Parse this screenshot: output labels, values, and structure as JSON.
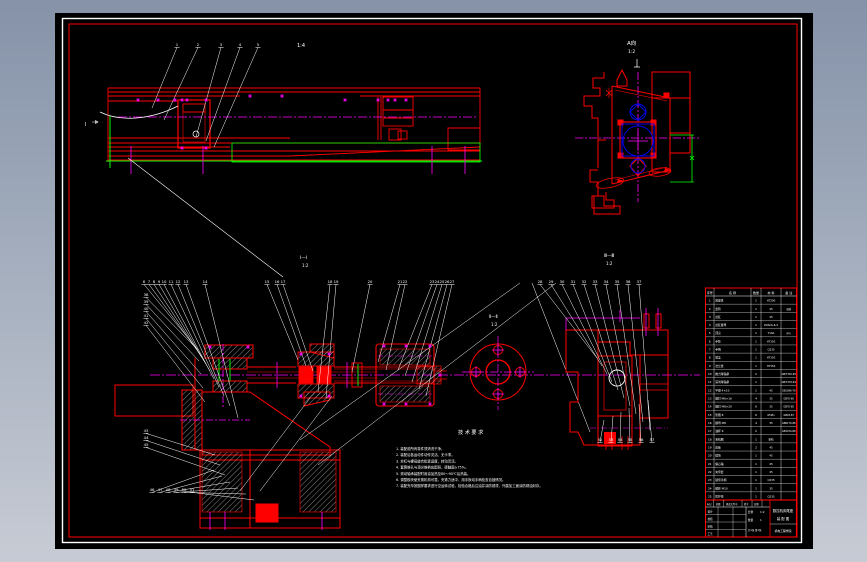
{
  "colors": {
    "background_top": "#8592a8",
    "background_bottom": "#c7cbd4",
    "sheet": "#000000",
    "border_white": "#ffffff",
    "border_red": "#ff0000",
    "line_green": "#00ff00",
    "centerline_magenta": "#ff00ff",
    "bearing_blue": "#0000ff",
    "text_white": "#ffffff"
  },
  "views": {
    "side": {
      "scale": "1:4",
      "section_mark": "Ⅰ"
    },
    "a": {
      "label": "A向",
      "scale": "1:2"
    },
    "main": {
      "label": "Ⅰ—Ⅰ",
      "scale": "1:2"
    },
    "flange": {
      "label": "Ⅱ—Ⅱ",
      "scale": "1:2"
    },
    "b": {
      "label": "Ⅲ—Ⅲ",
      "scale": "1:2"
    }
  },
  "balloons": {
    "side": [
      "1",
      "2",
      "3",
      "4",
      "5"
    ],
    "main_top": [
      "6",
      "7",
      "8",
      "9",
      "10",
      "11",
      "12",
      "13",
      "14"
    ],
    "main_mid": [
      "15",
      "16",
      "17"
    ],
    "main_mid2": [
      "18",
      "19"
    ],
    "main_shaft": [
      "20",
      "21",
      "22"
    ],
    "main_right": [
      "23",
      "24",
      "25",
      "26",
      "27"
    ],
    "main_far_right": [
      "28",
      "29",
      "30",
      "31",
      "32",
      "33",
      "34",
      "35",
      "36",
      "37"
    ],
    "main_left_stack": [
      "38",
      "39",
      "40",
      "41",
      "42"
    ],
    "main_bottom_stack": [
      "43",
      "44",
      "45"
    ],
    "main_bottom_row": [
      "46",
      "47",
      "48",
      "49",
      "50",
      "51"
    ],
    "b_bottom": [
      "52",
      "53",
      "54",
      "55",
      "56",
      "57"
    ]
  },
  "notes": {
    "title": "技术要求",
    "lines": [
      "1. 装配前所有零件须清洗干净。",
      "2. 装配后各运动件动作灵活、无卡滞。",
      "3. 丝杠与螺母旋合松紧适度，转动灵活。",
      "4. 套筒锥孔与顶尖锥柄应配研，接触面≥75%。",
      "5. 滚动轴承装配时用油加热至80～90℃后热装。",
      "6. 调整楔块使夹紧机构可靠，夹紧力适中，用手扳动手柄检查自锁情况。",
      "7. 装配完毕按图样要求进行空运转试验，检验合格后注油并涂防锈漆，外露加工面涂防锈油封存。"
    ]
  },
  "bom": {
    "headers": [
      "序号",
      "名  称",
      "数量",
      "材  料",
      "备  注"
    ],
    "rows": [
      [
        "1",
        "尾座体",
        "1",
        "HT200",
        ""
      ],
      [
        "2",
        "套筒",
        "1",
        "45",
        "调质"
      ],
      [
        "3",
        "丝杠",
        "1",
        "45",
        ""
      ],
      [
        "4",
        "丝杠螺母",
        "1",
        "ZQSn6-6-3",
        ""
      ],
      [
        "5",
        "顶尖",
        "1",
        "T10A",
        "淬火"
      ],
      [
        "6",
        "手轮",
        "1",
        "HT150",
        ""
      ],
      [
        "7",
        "手柄",
        "1",
        "Q235",
        ""
      ],
      [
        "8",
        "端盖",
        "1",
        "HT150",
        ""
      ],
      [
        "9",
        "法兰盘",
        "1",
        "HT150",
        ""
      ],
      [
        "10",
        "推力球轴承",
        "2",
        "",
        "GB/T301-95"
      ],
      [
        "11",
        "深沟球轴承",
        "1",
        "",
        "GB/T276-94"
      ],
      [
        "12",
        "平键 4×10",
        "1",
        "45",
        "GB1096-79"
      ],
      [
        "13",
        "螺钉 M6×16",
        "4",
        "35",
        "GB70-85"
      ],
      [
        "14",
        "螺钉 M8×20",
        "6",
        "35",
        "GB70-85"
      ],
      [
        "15",
        "垫圈 8",
        "6",
        "65Mn",
        "GB93-87"
      ],
      [
        "16",
        "螺母 M8",
        "4",
        "35",
        "GB6170-86"
      ],
      [
        "17",
        "油杯 6",
        "2",
        "",
        "GB1154-89"
      ],
      [
        "18",
        "毛毡圈",
        "1",
        "毛毡",
        ""
      ],
      [
        "19",
        "压板",
        "2",
        "45",
        ""
      ],
      [
        "20",
        "楔块",
        "1",
        "45",
        ""
      ],
      [
        "21",
        "偏心轴",
        "1",
        "45",
        ""
      ],
      [
        "22",
        "夹紧套",
        "1",
        "45",
        ""
      ],
      [
        "23",
        "锁紧手柄",
        "1",
        "Q235",
        ""
      ],
      [
        "24",
        "螺柱 M10",
        "1",
        "35",
        ""
      ],
      [
        "25",
        "防护罩",
        "1",
        "Q235",
        ""
      ]
    ]
  },
  "title_block": {
    "top_labels": [
      "标记",
      "处数",
      "更改文件号",
      "签字",
      "日期"
    ],
    "left_rows": [
      "设计",
      "校核",
      "审核",
      "工艺"
    ],
    "scale_label": "比例",
    "scale": "1:2",
    "qty_label": "数量",
    "qty": "1",
    "sheet_label": "共1张 第1张",
    "title_line1": "数控机床尾座",
    "title_line2": "装 配 图",
    "org": "机电工程学院"
  }
}
